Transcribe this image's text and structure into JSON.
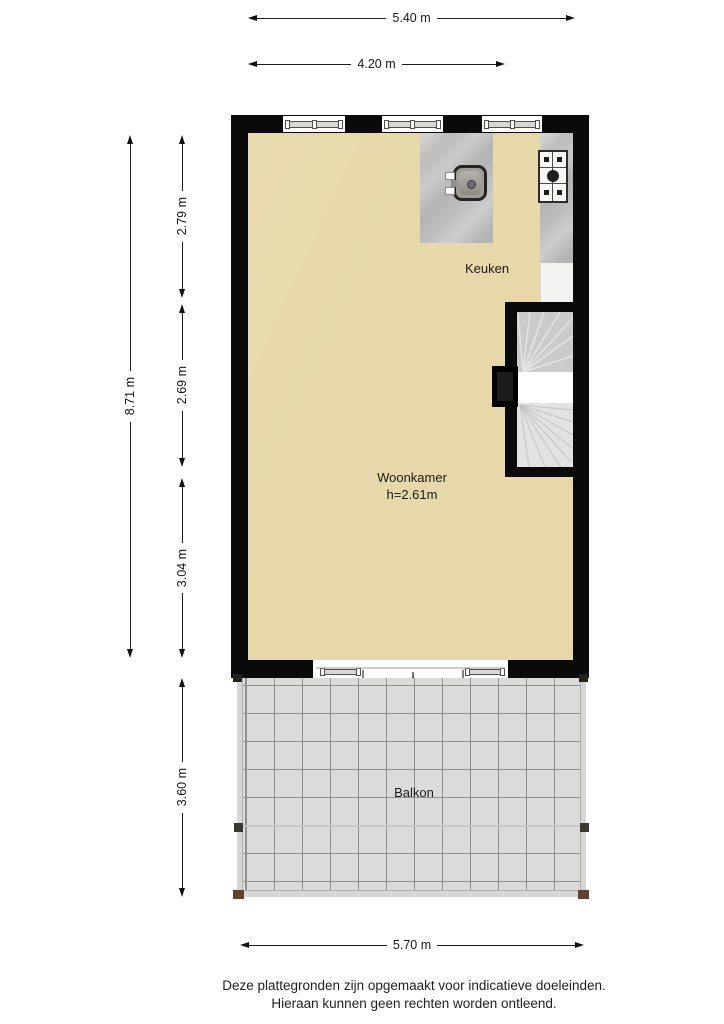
{
  "labels": {
    "kitchen": "Keuken",
    "living_room": "Woonkamer",
    "living_room_height": "h=2.61m",
    "balcony": "Balkon"
  },
  "dimensions": {
    "top_total": "5.40 m",
    "top_partial": "4.20 m",
    "left_total": "8.71 m",
    "left_top": "2.79 m",
    "left_middle": "2.69 m",
    "left_bottom": "3.04 m",
    "left_balcony": "3.60 m",
    "bottom_balcony": "5.70 m"
  },
  "footer": {
    "line1": "Deze plattegronden zijn opgemaakt voor indicatieve doeleinden.",
    "line2": "Hieraan kunnen geen rechten worden ontleend."
  },
  "colors": {
    "wall": "#0a0a0a",
    "floor": "#e6d8a9",
    "counter_marble": "#bcbcbc",
    "balcony_tile": "#dbdcd9",
    "tile_grid": "#8f8f8d",
    "stair_upper": "#cbcbcb",
    "stair_landing": "#ffffff",
    "stair_lower": "#e2e2e2",
    "post_wood": "#63422d"
  }
}
